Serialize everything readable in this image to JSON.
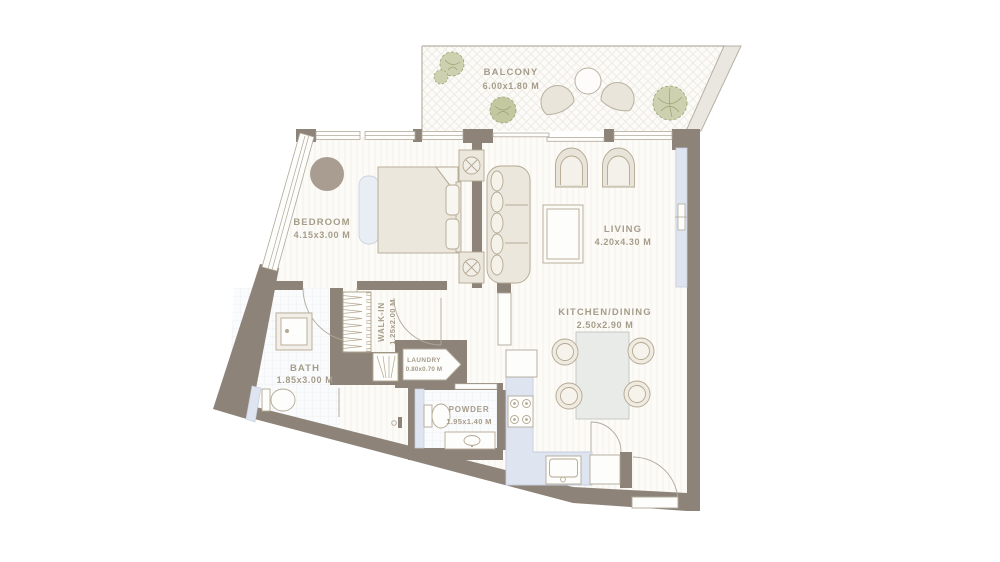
{
  "plan": {
    "title": "apartment-floor-plan",
    "rooms": [
      {
        "id": "balcony",
        "name": "BALCONY",
        "dims": "6.00x1.80 M"
      },
      {
        "id": "bedroom",
        "name": "BEDROOM",
        "dims": "4.15x3.00 M"
      },
      {
        "id": "living",
        "name": "LIVING",
        "dims": "4.20x4.30 M"
      },
      {
        "id": "kitchen_dining",
        "name": "KITCHEN/DINING",
        "dims": "2.50x2.90 M"
      },
      {
        "id": "walk_in",
        "name": "WALK-IN",
        "dims": "1.25x2.00 M"
      },
      {
        "id": "laundry",
        "name": "LAUNDRY",
        "dims": "0.80x0.70 M"
      },
      {
        "id": "bath",
        "name": "BATH",
        "dims": "1.85x3.00 M"
      },
      {
        "id": "powder",
        "name": "POWDER",
        "dims": "1.95x1.40 M"
      }
    ],
    "colors": {
      "wall": "#8d8379",
      "label_text": "#a69c8a",
      "furniture_line": "#b4a892",
      "glass_panel": "#dfe5f0",
      "rug": "#a89d90",
      "plant": "#cdd1b0"
    }
  }
}
